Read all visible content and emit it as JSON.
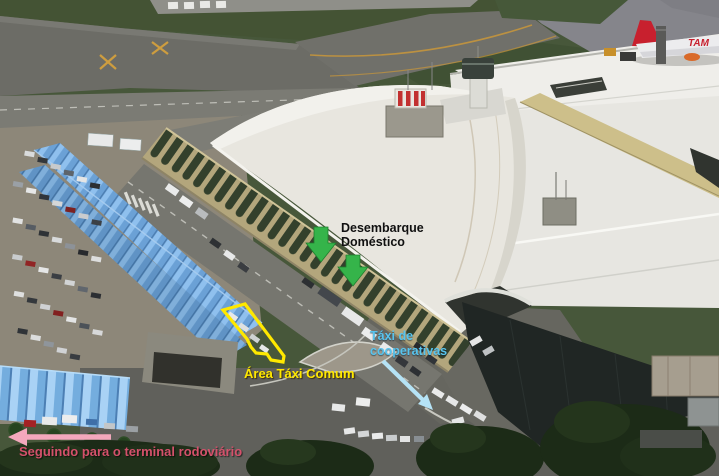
{
  "annotations": {
    "desembarque": {
      "line1": "Desembarque",
      "line2": "Doméstico",
      "text_color": "#101010",
      "arrow_color": "#35b44a"
    },
    "area_taxi_comum": {
      "label": "Área Táxi Comum",
      "color": "#ffe800"
    },
    "taxi_cooperativas": {
      "line1": "Táxi de",
      "line2": "cooperativas",
      "text_color": "#58c4ee",
      "arrow_color": "#b5e3f6"
    },
    "terminal_rodoviario": {
      "label": "Seguindo para o terminal rodoviário",
      "text_color": "#d4516b",
      "arrow_color": "#f3a8bc"
    }
  },
  "scene": {
    "aircraft_logo": "TAM",
    "palette": {
      "grass": "#47573a",
      "runway": "#8f8f89",
      "taxiway": "#6c6c66",
      "apron": "#85858b",
      "white_roof": "#e7e6e1",
      "cream_wall": "#cdbf8a",
      "dark_building": "#202624",
      "canopy_blue": "#7db1e2",
      "parking_asphalt": "#8d8779",
      "road": "#60605b",
      "trees": "#1c2b17",
      "aircraft_red": "#c8202e"
    }
  }
}
